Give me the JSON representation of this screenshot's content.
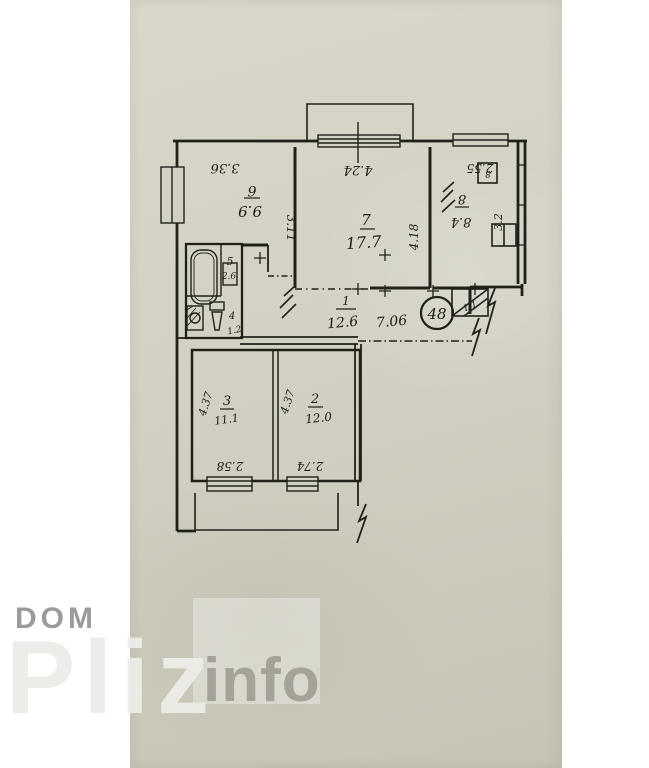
{
  "watermark": {
    "dom": "DOM",
    "pliz": "Pliz",
    "info": "info"
  },
  "plan": {
    "badge": "48",
    "closet_area": "1.1",
    "vent_label": "8",
    "rooms": {
      "r7": {
        "num": "7",
        "area": "17.7",
        "w": "4.24",
        "h": "4.18"
      },
      "r6": {
        "num": "6",
        "area": "9.9",
        "w": "3.36",
        "h": "3.11"
      },
      "r8": {
        "num": "8",
        "area": "8.4",
        "w": "2.55",
        "h": "3.2"
      },
      "hall": {
        "num": "1",
        "area": "12.6",
        "w": "7.06"
      },
      "r3": {
        "num": "3",
        "area": "11.1",
        "w": "2.58",
        "h": "4.37"
      },
      "r2": {
        "num": "2",
        "area": "12.0",
        "w": "2.74",
        "h": "4.37"
      },
      "bath": {
        "num": "5",
        "area": "2.6"
      },
      "wc": {
        "num": "4",
        "area": "1.2"
      }
    }
  }
}
